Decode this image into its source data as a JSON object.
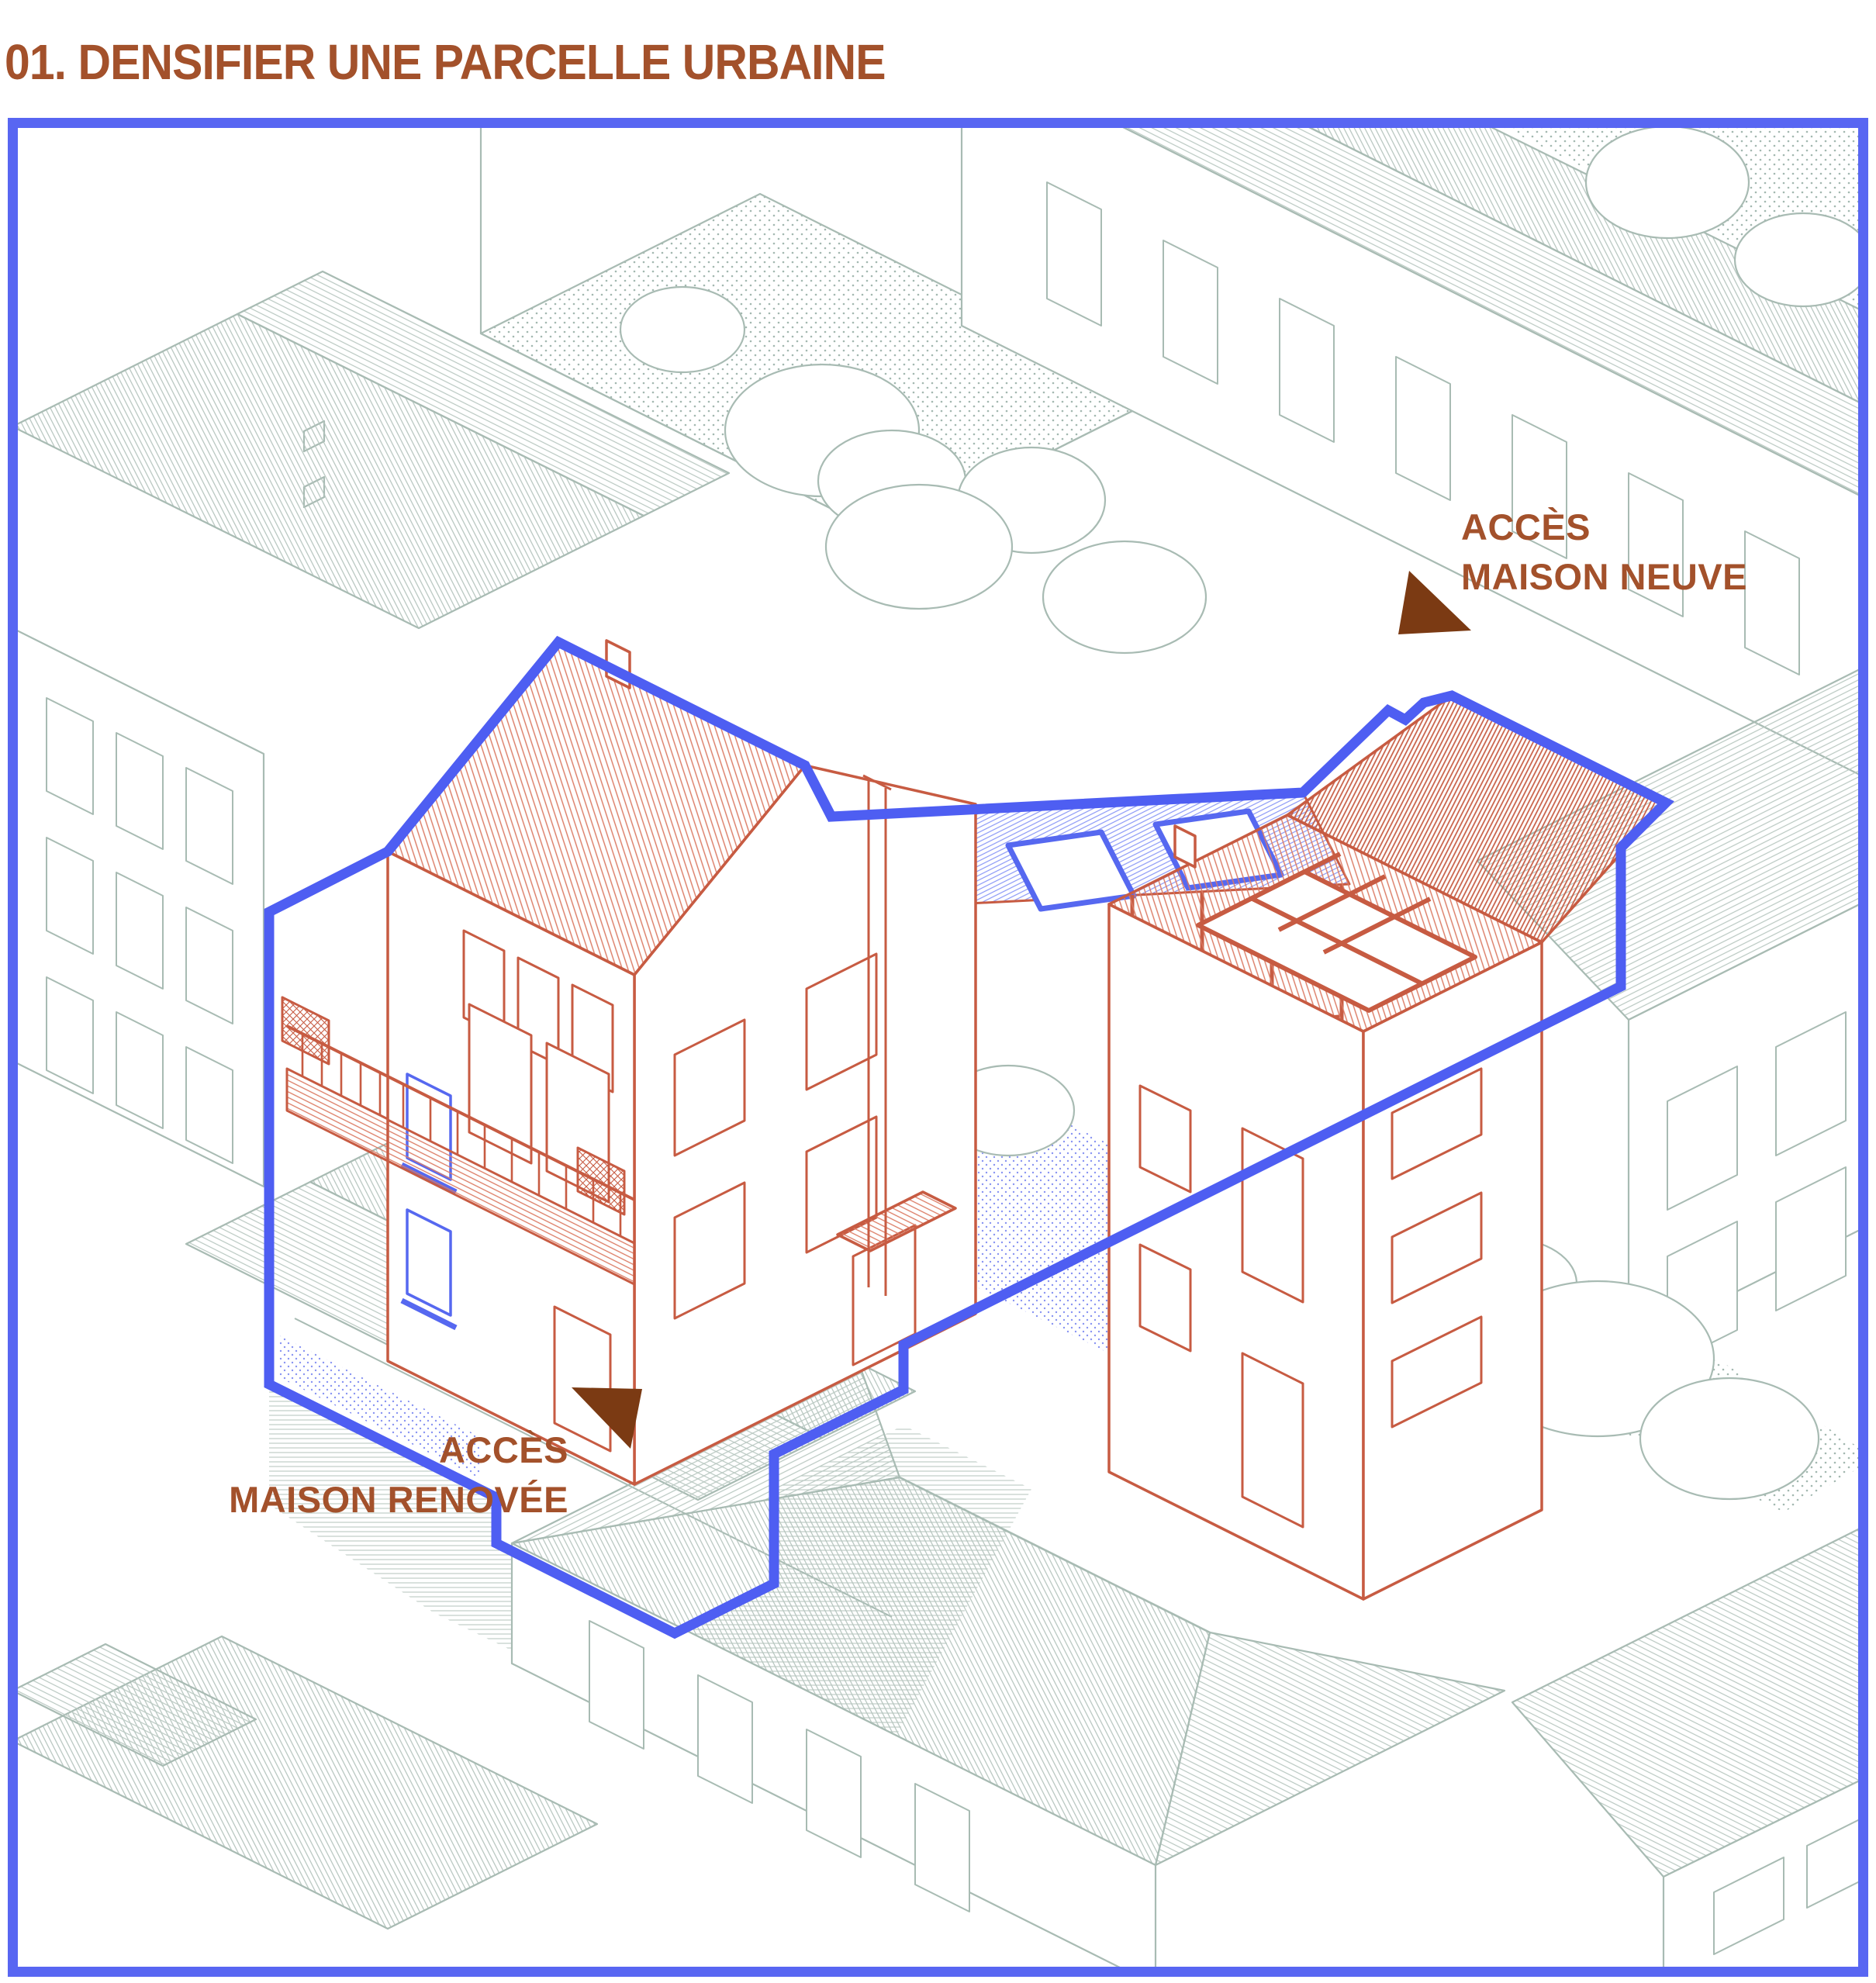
{
  "title": "01. DENSIFIER UNE PARCELLE URBAINE",
  "figure": {
    "type": "axonometric urban site diagram",
    "annotations": {
      "acces_maison_neuve": {
        "line1": "ACCÈS",
        "line2": "MAISON NEUVE"
      },
      "acces_maison_renovee": {
        "line1": "ACCÈS",
        "line2": "MAISON RENOVÉE"
      }
    },
    "colors": {
      "title_text": "#A3512B",
      "annotation_text": "#A3512B",
      "arrow_brown": "#7B3A13",
      "frame_blue": "#5866F2",
      "parcel_outline_blue": "#4E5EF2",
      "project_red": "#C75B42",
      "existing_blue": "#5668F0",
      "context_green": "#A8BBB3",
      "glazing_blue": "#8A97F6"
    }
  }
}
